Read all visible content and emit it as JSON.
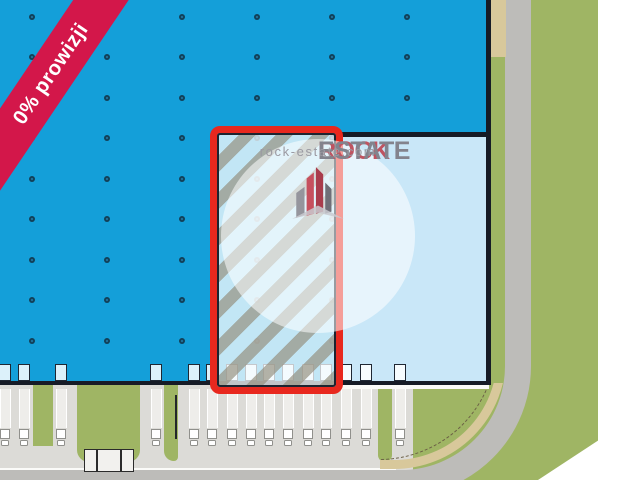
{
  "plan": {
    "ribbon": {
      "label": "0% prowizji",
      "color": "#d3174a"
    },
    "watermark": {
      "brand_first": "ROCK",
      "brand_second": "ESTATE",
      "website": "rock-estate.com"
    },
    "colors": {
      "highlight_red": "#e8281e",
      "building_blue": "#149fd9",
      "unit_light_blue": "#c9e7f8",
      "grass_green": "#9fb564",
      "road_gray": "#bdbcb9",
      "sidewalk_tan": "#d8c89b",
      "outline_dark": "#161b26"
    }
  }
}
